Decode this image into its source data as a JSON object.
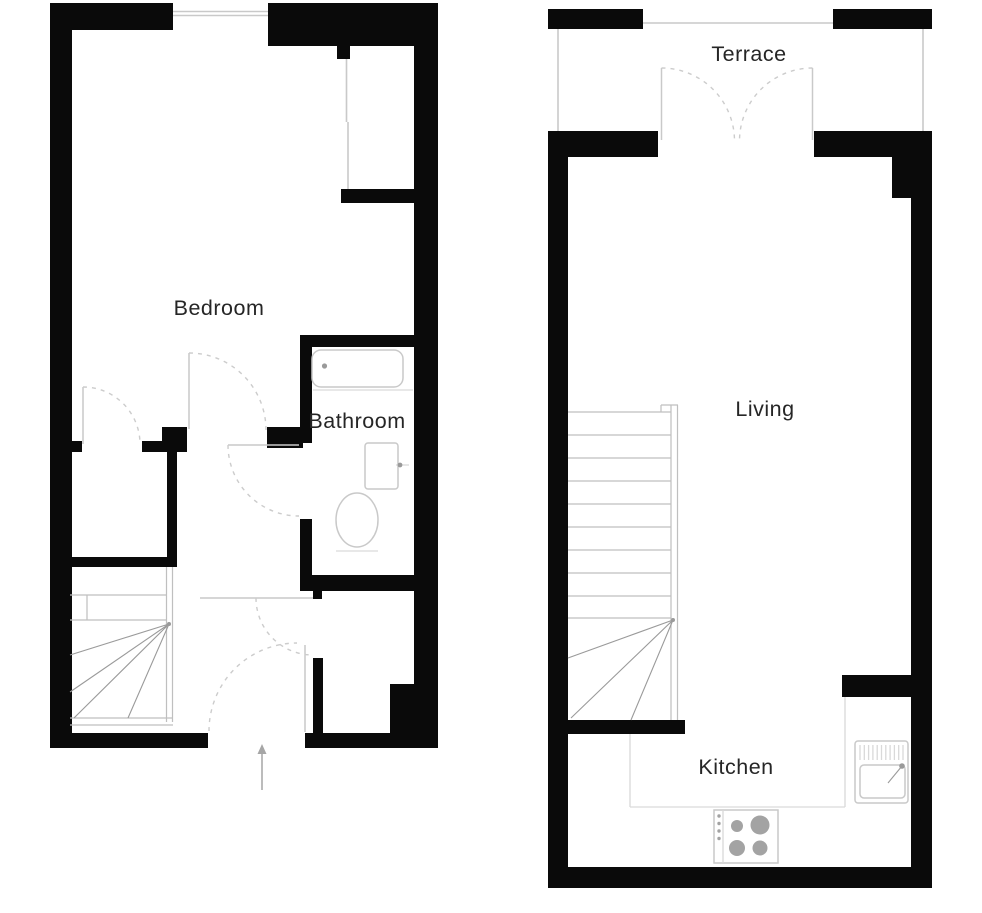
{
  "plans": {
    "left": {
      "labels": {
        "bedroom": "Bedroom",
        "bathroom": "Bathroom"
      }
    },
    "right": {
      "labels": {
        "terrace": "Terrace",
        "living": "Living",
        "kitchen": "Kitchen"
      }
    }
  },
  "icons": {
    "bathtub-icon": "rounded-rect-with-drain-dot",
    "toilet-icon": "ellipse-bowl-with-base-line",
    "washbasin-icon": "rect-with-tap-dot",
    "kitchen-sink-icon": "basin-with-drainboard-hatch-and-tap",
    "hob-icon": "four-burner-circles-with-control-dots",
    "stairs-icon": "straight-treads-with-winder-fan",
    "door-swing-icon": "dashed-quarter-arc",
    "french-doors-icon": "two-dashed-quarter-arcs-meeting",
    "window-icon": "thin-parallel-lines-in-wall-gap",
    "entry-arrow-icon": "upward-arrow"
  },
  "colors": {
    "bg": "#ffffff",
    "wall": "#0a0a0a",
    "line": "#c9c9c9",
    "soft": "#d9d9d9",
    "dash": "#cccccc",
    "stair": "#bfbfbf",
    "fan": "#9a9a9a",
    "burner": "#a3a3a3",
    "arrow": "#a6a6a6",
    "text": "#262626"
  }
}
